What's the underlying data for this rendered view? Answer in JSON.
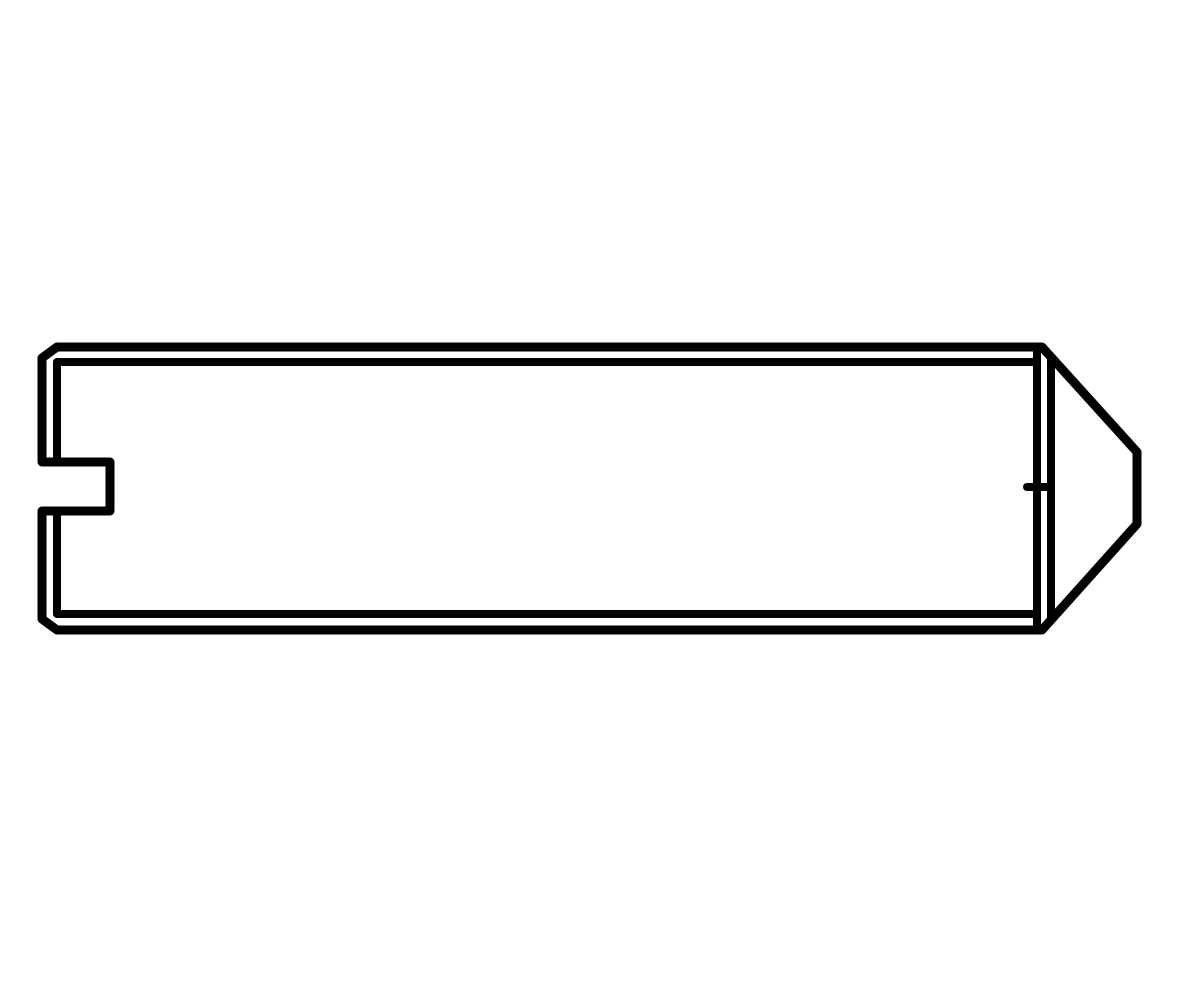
{
  "page": {
    "background_color": "#ffffff"
  },
  "drawing": {
    "alt": "Black-and-white technical line drawing, side view of a slotted set screw with cone point: long cylindrical body, screwdriver slot notch on the left end face, chamfered left corners, and a flattened cone point on the right end",
    "ink_color": "#000000",
    "viewbox": "0 0 1200 1000",
    "canvas": {
      "width": 1200,
      "height": 1000
    },
    "paths": {
      "silhouette": "M 57 347 L 1042 347 L 1137 452 L 1137 524 L 1042 630 L 57 630 L 42 619 L 42 511 L 110 511 L 110 462 L 42 462 L 42 358 Z",
      "top_edge_inner": "M 1035 362 L 57 362 L 57 462",
      "bottom_edge_inner": "M 1035 614 L 57 614 L 57 511",
      "end_face_edge": "M 1037 347 L 1037 630",
      "point_base_edge": "M 1051 357 L 1051 620",
      "center_mark": "M 1027 487 L 1051 487"
    }
  }
}
